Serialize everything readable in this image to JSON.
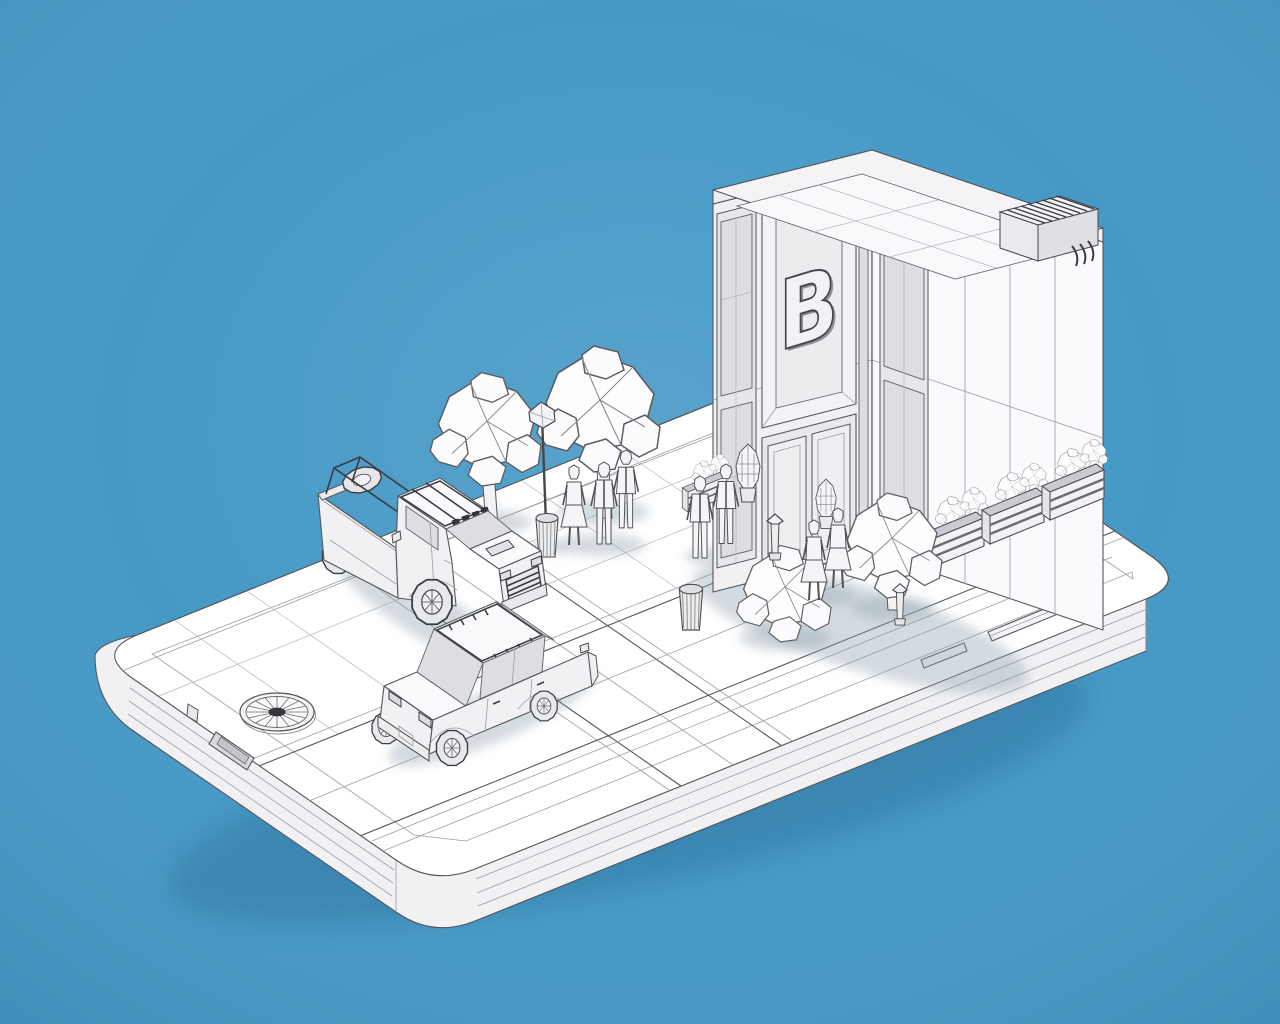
{
  "scene": {
    "title": "Low-poly wireframe city block rendered on the back of a smartphone",
    "style": "3d-wireframe-render",
    "background_color": "#4699c6",
    "wireframe_line_color": "#55565b",
    "surface_color": "#ffffff",
    "glass_color": "#dcdee2",
    "accent_dark_color": "#35363b",
    "shadow_color": "#8fa0ad"
  },
  "building": {
    "logo_letter": "B",
    "floors": 2,
    "features": [
      "raised letter-B signage panel",
      "double entrance doors",
      "two-story window strips",
      "rooftop parapet with grid",
      "rooftop AC unit with fins and pipes",
      "planter boxes with shrubs"
    ]
  },
  "phone": {
    "features": [
      "rounded rectangular slab",
      "rear camera lens with radial iris",
      "port opening on front edge",
      "volume button",
      "power button",
      "small side key"
    ]
  },
  "vehicles": [
    {
      "name": "pickup-truck",
      "details": "roof rack with 4 lights, roll-bar cage, spare tire in bed, barred grille, hood scoop"
    },
    {
      "name": "sedan",
      "details": "roof rack with tie-downs, rear view with taillights and bumper"
    }
  ],
  "street_furniture": [
    "street lamp with faceted lantern",
    "trash can at lamp base",
    "round trash bin",
    "bollard light",
    "bollard light"
  ],
  "vegetation": {
    "trees": 3,
    "large_bush": 1,
    "planter_shrub_boxes": 4,
    "cone_shrubs": 2
  },
  "people": {
    "count": 7,
    "groups": [
      {
        "location": "near street lamp",
        "count": 3
      },
      {
        "location": "in front of entrance doors",
        "count": 2
      },
      {
        "location": "right walkway by planters",
        "count": 2
      }
    ]
  }
}
